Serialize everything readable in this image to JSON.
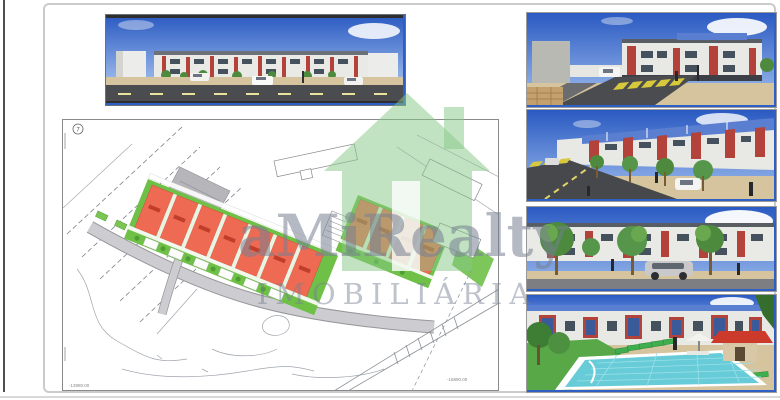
{
  "watermark": {
    "brand": "aMiRealty",
    "subtitle": "IMOBILIÁRIA",
    "house_color": "#86c886",
    "text_color": "#768092"
  },
  "site_plan": {
    "sheet_marker": "7",
    "coord_label_left": "-13980.00",
    "coord_label_right": "-16890.00",
    "colors": {
      "roof_red": "#ef6a52",
      "unit_label_red": "#bd3a26",
      "green": "#6fc047",
      "green_dark": "#4f9e33",
      "road_gray": "#c6c6ca",
      "line_gray": "#8b9097",
      "contour_gray": "#a0a6ae"
    }
  },
  "renders": {
    "sky_top": "#2d5fc4",
    "sky_horizon": "#8fb0e6",
    "building_white": "#e9e9e5",
    "accent_red": "#b2423a",
    "road_dark": "#4a4c50",
    "sand": "#d5c49e",
    "tree_green": "#4d8a3e",
    "pool_water": "#67ccd8",
    "lounger_green": "#3fae4f",
    "kiosk_roof_red": "#cc3a2c",
    "crosswalk_yellow": "#d8c83c"
  }
}
